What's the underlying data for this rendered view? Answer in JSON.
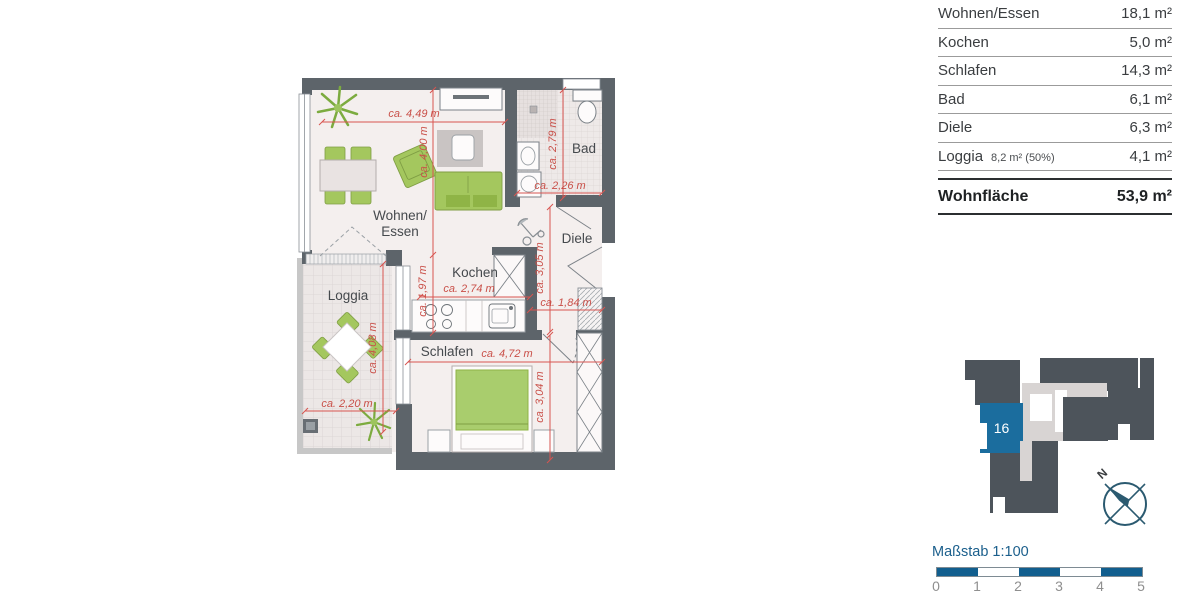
{
  "table": {
    "rows": [
      {
        "label": "Wohnen/Essen",
        "note": "",
        "value": "18,1 m²"
      },
      {
        "label": "Kochen",
        "note": "",
        "value": "5,0 m²"
      },
      {
        "label": "Schlafen",
        "note": "",
        "value": "14,3 m²"
      },
      {
        "label": "Bad",
        "note": "",
        "value": "6,1 m²"
      },
      {
        "label": "Diele",
        "note": "",
        "value": "6,3 m²"
      },
      {
        "label": "Loggia",
        "note": "8,2 m² (50%)",
        "value": "4,1 m²"
      }
    ],
    "total": {
      "label": "Wohnfläche",
      "value": "53,9 m²"
    }
  },
  "plan": {
    "rooms": {
      "wohnen_line1": "Wohnen/",
      "wohnen_line2": "Essen",
      "kochen": "Kochen",
      "bad": "Bad",
      "diele": "Diele",
      "schlafen": "Schlafen",
      "loggia": "Loggia"
    },
    "dims": {
      "d449": "ca. 4,49 m",
      "d400": "ca. 4,00 m",
      "d279": "ca. 2,79 m",
      "d226": "ca. 2,26 m",
      "d305": "ca. 3,05 m",
      "d184": "ca. 1,84 m",
      "d197": "ca. 1,97 m",
      "d274": "ca. 2,74 m",
      "d472": "ca. 4,72 m",
      "d304": "ca. 3,04 m",
      "d408": "ca. 4,08 m",
      "d220": "ca. 2,20 m"
    }
  },
  "siteplan": {
    "unit_label": "16"
  },
  "compass": {
    "north_label": "N"
  },
  "scalebar": {
    "title": "Maßstab 1:100",
    "ticks": [
      "0",
      "1",
      "2",
      "3",
      "4",
      "5"
    ]
  },
  "colors": {
    "wall": "#5d646a",
    "dimension_red": "#d85450",
    "furniture_green": "#a4c75e",
    "unit_blue": "#1b6d9e",
    "scale_blue": "#115e8e"
  }
}
